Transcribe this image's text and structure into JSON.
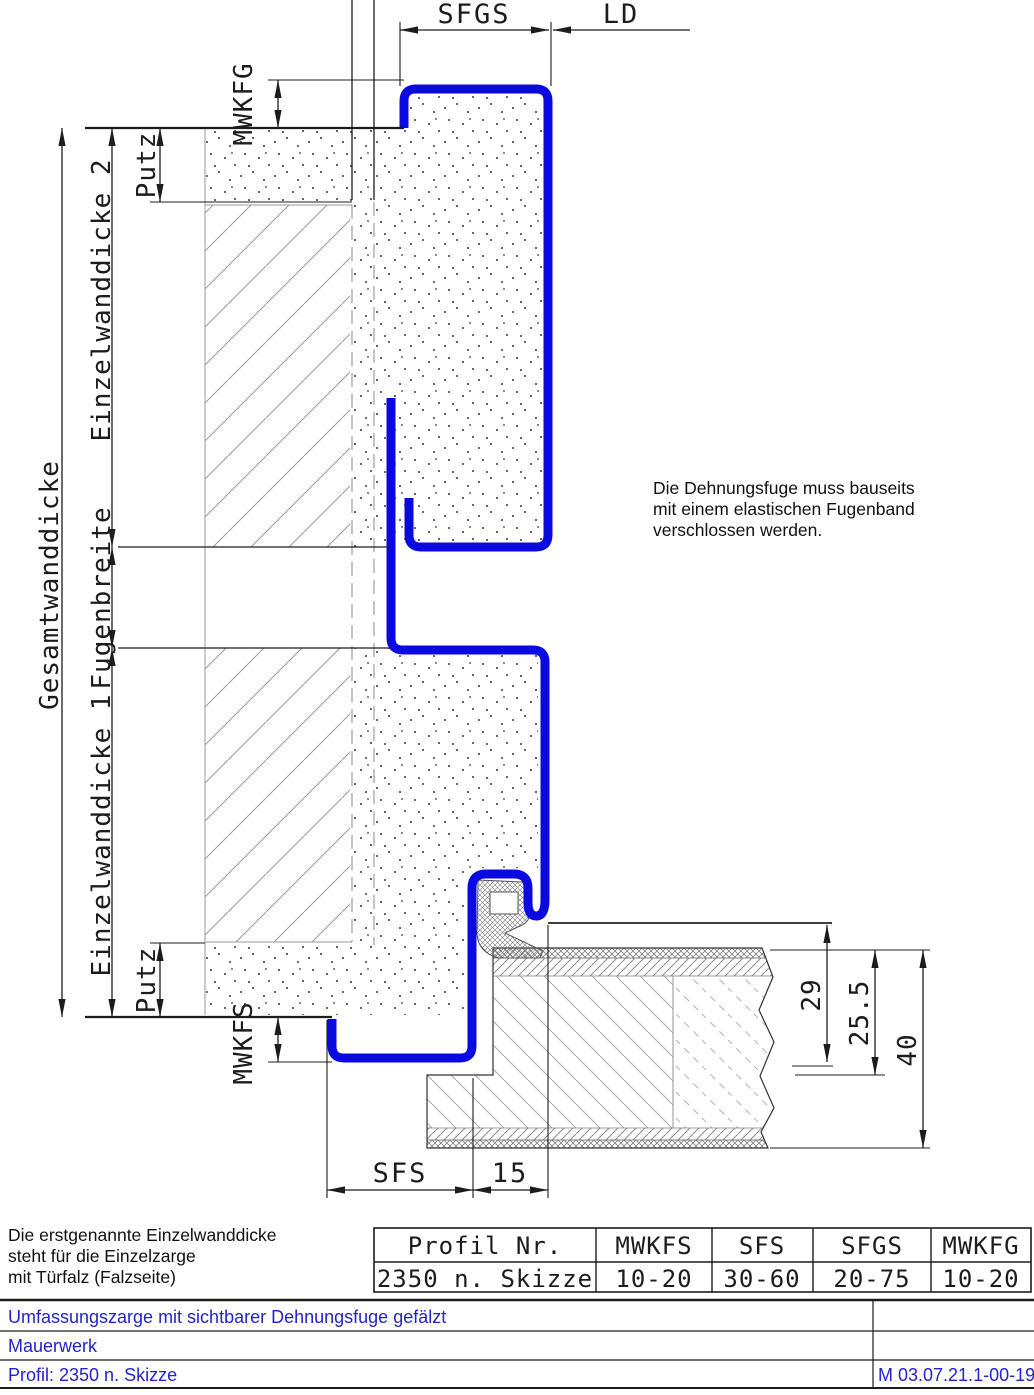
{
  "dimensions": {
    "top": {
      "sfgs": "SFGS",
      "ld": "LD"
    },
    "left": {
      "mwkfg": "MWKFG",
      "putz_top": "Putz",
      "einzelwanddicke2": "Einzelwanddicke 2",
      "gesamtwanddicke": "Gesamtwanddicke",
      "fugenbreite": "Fugenbreite",
      "einzelwanddicke1": "Einzelwanddicke 1",
      "putz_bottom": "Putz",
      "mwkfs": "MWKFS"
    },
    "bottom": {
      "sfs": "SFS",
      "fifteen": "15"
    },
    "right": {
      "d29": "29",
      "d25_5": "25.5",
      "d40": "40"
    }
  },
  "notes": {
    "dehnungsfuge": [
      "Die Dehnungsfuge muss bauseits",
      "mit einem elastischen Fugenband",
      "verschlossen werden."
    ],
    "einzelwanddicke": [
      "Die erstgenannte Einzelwanddicke",
      "steht für die Einzelzarge",
      "mit Türfalz (Falzseite)"
    ]
  },
  "profile_table": {
    "headers": [
      "Profil Nr.",
      "MWKFS",
      "SFS",
      "SFGS",
      "MWKFG"
    ],
    "row": [
      "2350 n. Skizze",
      "10-20",
      "30-60",
      "20-75",
      "10-20"
    ]
  },
  "title_block": {
    "line1": "Umfassungszarge mit sichtbarer Dehnungsfuge gefälzt",
    "line2": "Mauerwerk",
    "line3": "Profil: 2350 n. Skizze",
    "drawing_number": "M 03.07.21.1-00-19"
  },
  "colors": {
    "profile_blue": "#0a0ae0",
    "title_text": "#2323c8",
    "line_black": "#1c1c1c"
  }
}
